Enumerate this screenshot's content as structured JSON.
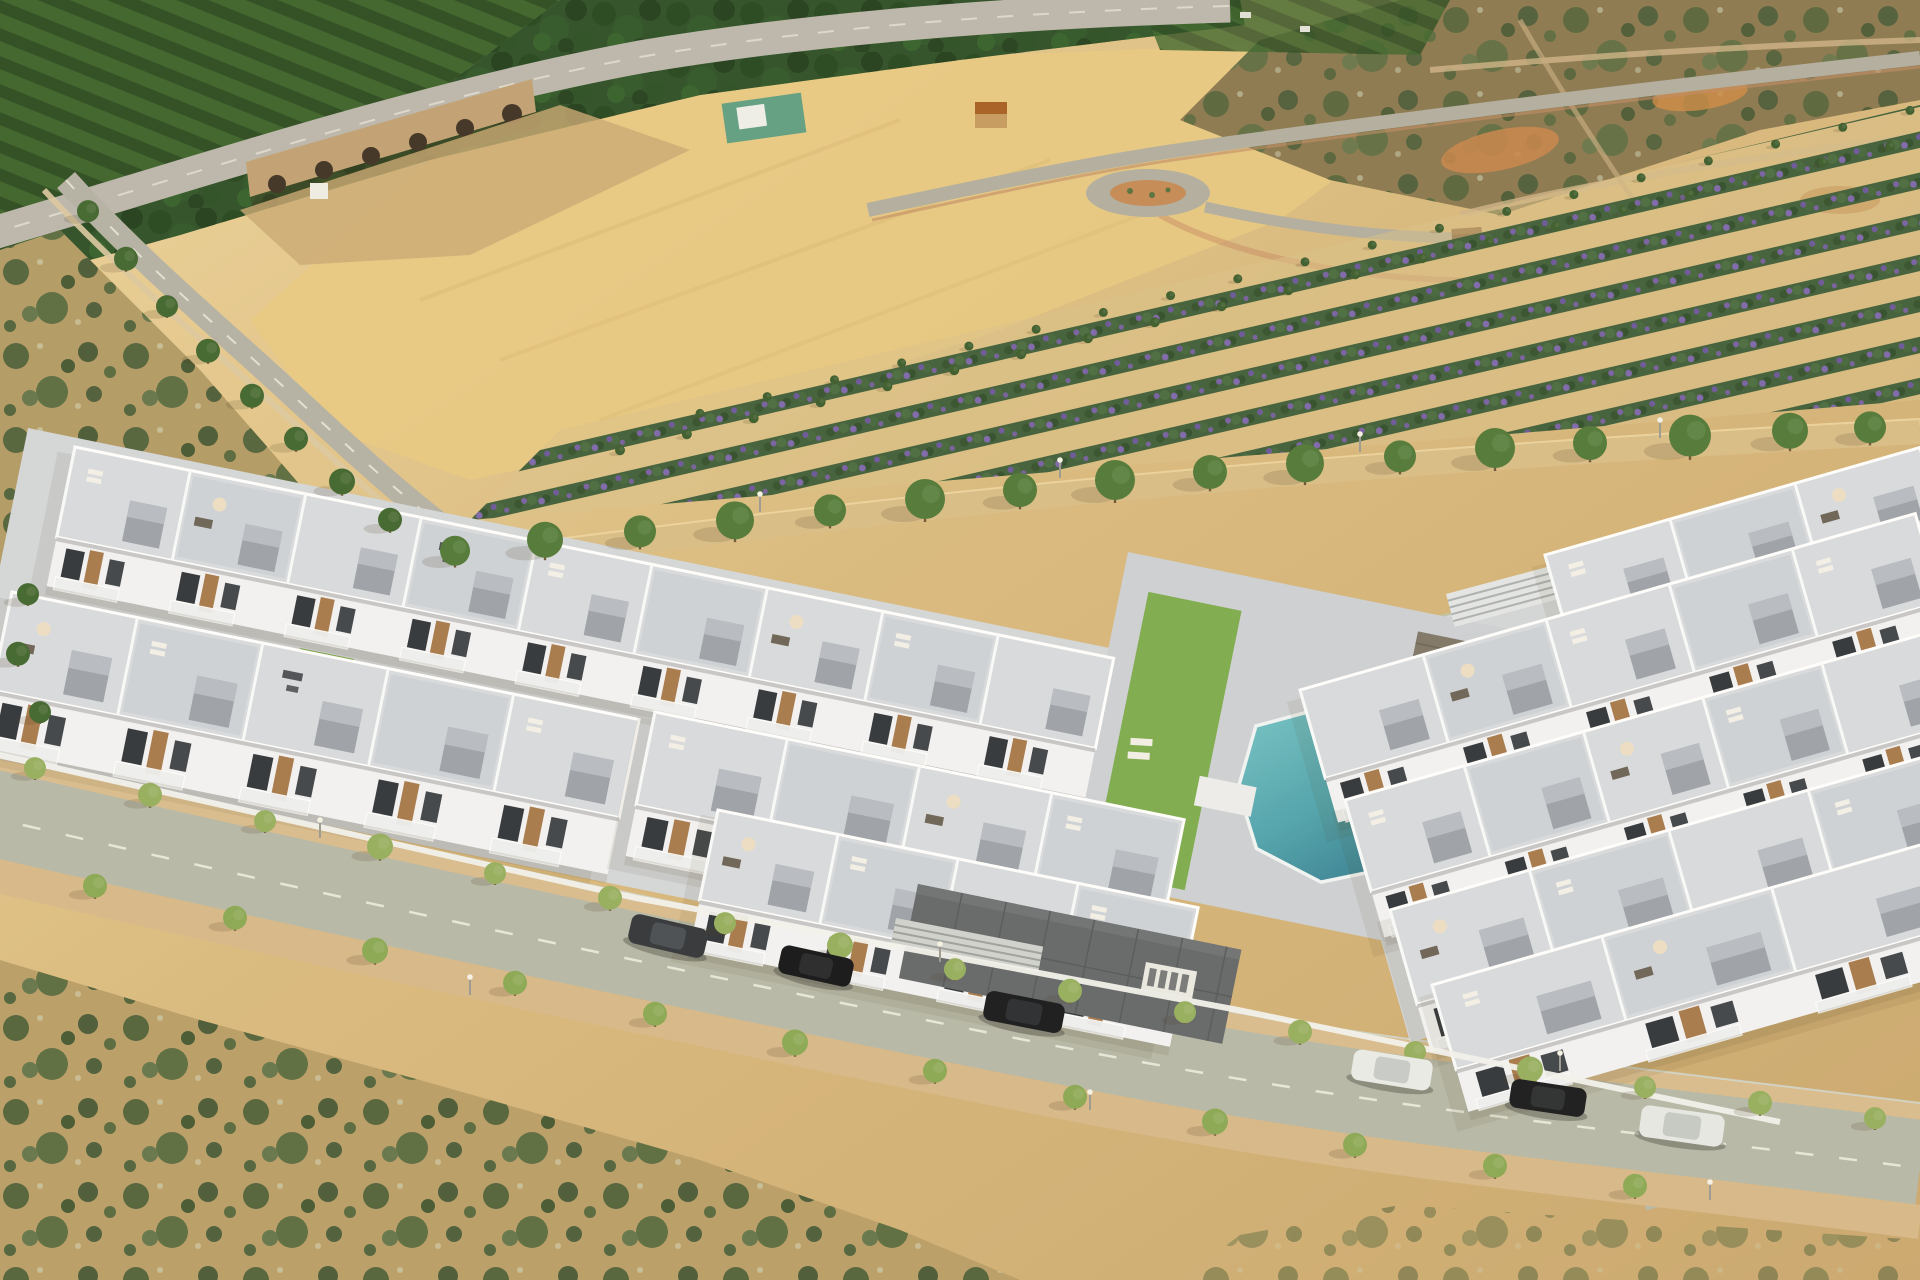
{
  "scene_type": "aerial-photograph-render-of-residential-complex",
  "palette": {
    "sand_light": "#ecd49c",
    "sand_mid": "#d9ba7e",
    "sand_dark": "#c19e66",
    "wheat": "#e8ca82",
    "scrub_tr": "#8a7850",
    "scrub_left": "#b29a66",
    "forest": "#2c4f26",
    "orchard_dark": "#294a20",
    "orchard_mid": "#3c652c",
    "highway": "#bab7ac",
    "road_curve": "#b3b0a5",
    "road_top": "#b0ad9f",
    "road_edge_red": "#c08b63",
    "roundabout_inner": "#c58a55",
    "bridge": "#c0a173",
    "bridge_arch": "#3e3123",
    "ravine": "#c9a873",
    "red_dirt": "#c8854a",
    "path_light": "#cdb387",
    "crop_green": "#3f5e39",
    "crop_purple": "#7b5fae",
    "avenue": "#d9bd87",
    "avenue_edge": "#ecd5a0",
    "canal": "#bcc4a6",
    "street": "#b5b8a7",
    "sidewalk_upper": "#d8bc8e",
    "sidewalk_lower": "#d6b88a",
    "dash": "#eef0e4",
    "wall": "#f1f2ee",
    "glass_fence": "#cfdad6",
    "pad": "#d3d6da",
    "pad_right": "#d2d5d8",
    "courtyard": "#ccd0d4",
    "deck": "#d7dbdf",
    "deck_alt": "#cdd2d8",
    "parapet_white": "#f8fafb",
    "facade": "#f2f3f4",
    "bulkhead": "#9ba1a9",
    "bulkhead_top": "#b6bcc3",
    "wood": "#a6794b",
    "window": "#2f343a",
    "balcony": "#eef1f2",
    "lawn": "#7cab4d",
    "lawn2": "#7fae50",
    "pool_rim": "#f1f5f5",
    "terrace_dark": "#63676a",
    "wood_deck": "#7e7568",
    "fence_teal": "#2f9080",
    "hut_roof": "#a65e22",
    "kiosk": "#6f4f2e",
    "parasol": "#ecdfc6",
    "sofa_dark": "#6b6257",
    "tree_avenue": "#4e7836",
    "tree_street": "#94ae5e",
    "tree_street_low": "#8aa854",
    "tree_road": "#3f652e",
    "tree_crop": "#3a5c2c",
    "trunk": "#6d5435",
    "lamp_pole": "#9a9a92",
    "lamp_head": "#f4f2e6",
    "shadow": "rgba(70,55,28,0.32)"
  },
  "scene": {
    "building_rows": [
      {
        "id": "row-a",
        "x": 75,
        "y": 447,
        "a": 11.5,
        "len": 1060,
        "depth": 92,
        "fh": 50,
        "units": 9,
        "furn": [
          1,
          2,
          0,
          3,
          1,
          0,
          2,
          1,
          0
        ]
      },
      {
        "id": "row-r0",
        "x": 1545,
        "y": 555,
        "a": -16,
        "len": 390,
        "depth": 78,
        "fh": 36,
        "units": 3,
        "furn": [
          1,
          0,
          2
        ]
      },
      {
        "id": "row-b",
        "x": 12,
        "y": 592,
        "a": 11.5,
        "len": 640,
        "depth": 100,
        "fh": 58,
        "units": 5,
        "furn": [
          2,
          1,
          3,
          0,
          1
        ]
      },
      {
        "id": "row-r1",
        "x": 1300,
        "y": 690,
        "a": -16,
        "len": 640,
        "depth": 92,
        "fh": 46,
        "units": 5,
        "furn": [
          0,
          2,
          1,
          0,
          1
        ]
      },
      {
        "id": "row-d",
        "x": 655,
        "y": 712,
        "a": 11.5,
        "len": 540,
        "depth": 95,
        "fh": 52,
        "units": 4,
        "furn": [
          1,
          0,
          2,
          1
        ]
      },
      {
        "id": "row-r2",
        "x": 1345,
        "y": 800,
        "a": -16,
        "len": 620,
        "depth": 95,
        "fh": 48,
        "units": 5,
        "furn": [
          1,
          0,
          2,
          1,
          0
        ]
      },
      {
        "id": "row-e",
        "x": 718,
        "y": 810,
        "a": 11.5,
        "len": 490,
        "depth": 92,
        "fh": 50,
        "units": 4,
        "furn": [
          2,
          1,
          0,
          1
        ]
      },
      {
        "id": "row-r3",
        "x": 1390,
        "y": 910,
        "a": -16,
        "len": 580,
        "depth": 98,
        "fh": 50,
        "units": 4,
        "furn": [
          2,
          1,
          0,
          1
        ]
      },
      {
        "id": "row-r4",
        "x": 1432,
        "y": 985,
        "a": -16,
        "len": 530,
        "depth": 88,
        "fh": 44,
        "units": 3,
        "furn": [
          1,
          2,
          0
        ]
      }
    ],
    "cars": [
      {
        "x": 668,
        "y": 936,
        "a": 13,
        "len": 78,
        "w": 30,
        "body": "#303439",
        "roof": "#474c52",
        "kind": "dark-suv"
      },
      {
        "x": 816,
        "y": 966,
        "a": 12.5,
        "len": 74,
        "w": 29,
        "body": "#121417",
        "roof": "#232629",
        "kind": "black-hatchback"
      },
      {
        "x": 1024,
        "y": 1012,
        "a": 11,
        "len": 80,
        "w": 30,
        "body": "#16181c",
        "roof": "#282b2f",
        "kind": "black-sedan"
      },
      {
        "x": 1392,
        "y": 1070,
        "a": 9,
        "len": 80,
        "w": 31,
        "body": "#e9ebe9",
        "roof": "#c7cbca",
        "kind": "white-compact"
      },
      {
        "x": 1548,
        "y": 1098,
        "a": 8.5,
        "len": 76,
        "w": 29,
        "body": "#17191c",
        "roof": "#2a2d30",
        "kind": "black-sedan"
      },
      {
        "x": 1682,
        "y": 1126,
        "a": 8,
        "len": 84,
        "w": 32,
        "body": "#e6e8e5",
        "roof": "#c5c9c6",
        "kind": "white-crossover"
      }
    ],
    "avenue_trees": [
      [
        455,
        556,
        15
      ],
      [
        545,
        546,
        18
      ],
      [
        640,
        537,
        16
      ],
      [
        735,
        527,
        19
      ],
      [
        830,
        516,
        16
      ],
      [
        925,
        506,
        20
      ],
      [
        1020,
        496,
        17
      ],
      [
        1115,
        487,
        20
      ],
      [
        1210,
        478,
        17
      ],
      [
        1305,
        470,
        19
      ],
      [
        1400,
        462,
        16
      ],
      [
        1495,
        455,
        20
      ],
      [
        1590,
        449,
        17
      ],
      [
        1690,
        443,
        21
      ],
      [
        1790,
        437,
        18
      ],
      [
        1870,
        433,
        16
      ]
    ],
    "road_trees": [
      [
        88,
        215,
        11
      ],
      [
        126,
        263,
        12
      ],
      [
        167,
        310,
        11
      ],
      [
        208,
        355,
        12
      ],
      [
        252,
        400,
        12
      ],
      [
        296,
        443,
        12
      ],
      [
        342,
        486,
        13
      ],
      [
        390,
        524,
        12
      ],
      [
        28,
        598,
        11
      ],
      [
        18,
        658,
        12
      ],
      [
        40,
        716,
        11
      ]
    ],
    "street_trees_upper": [
      [
        35,
        772,
        11
      ],
      [
        150,
        799,
        12
      ],
      [
        265,
        825,
        11
      ],
      [
        380,
        851,
        13
      ],
      [
        495,
        877,
        11
      ],
      [
        610,
        902,
        12
      ],
      [
        725,
        927,
        11
      ],
      [
        840,
        950,
        13
      ],
      [
        955,
        973,
        11
      ],
      [
        1070,
        995,
        12
      ],
      [
        1185,
        1016,
        11
      ],
      [
        1300,
        1036,
        12
      ],
      [
        1415,
        1056,
        11
      ],
      [
        1530,
        1074,
        13
      ],
      [
        1645,
        1091,
        11
      ],
      [
        1760,
        1107,
        12
      ],
      [
        1875,
        1122,
        11
      ]
    ],
    "street_trees_lower": [
      [
        95,
        890,
        12
      ],
      [
        235,
        922,
        12
      ],
      [
        375,
        955,
        13
      ],
      [
        515,
        987,
        12
      ],
      [
        655,
        1018,
        12
      ],
      [
        795,
        1047,
        13
      ],
      [
        935,
        1075,
        12
      ],
      [
        1075,
        1101,
        12
      ],
      [
        1215,
        1126,
        13
      ],
      [
        1355,
        1149,
        12
      ],
      [
        1495,
        1170,
        12
      ],
      [
        1635,
        1190,
        12
      ]
    ],
    "crop_tree_lines": [
      {
        "x1": 620,
        "y1": 452,
        "x2": 1890,
        "y2": 148,
        "n": 20,
        "r": 5
      },
      {
        "x1": 700,
        "y1": 415,
        "x2": 1910,
        "y2": 112,
        "n": 19,
        "r": 4.5
      }
    ],
    "lamps": [
      [
        320,
        838
      ],
      [
        940,
        962
      ],
      [
        1560,
        1071
      ],
      [
        470,
        995
      ],
      [
        1090,
        1110
      ],
      [
        1710,
        1200
      ],
      [
        760,
        512
      ],
      [
        1060,
        478
      ],
      [
        1360,
        452
      ],
      [
        1660,
        438
      ]
    ],
    "courtyard_lawns": [
      [
        395,
        563,
        70,
        26
      ],
      [
        300,
        648,
        55,
        20
      ],
      [
        652,
        738,
        60,
        22
      ]
    ]
  }
}
